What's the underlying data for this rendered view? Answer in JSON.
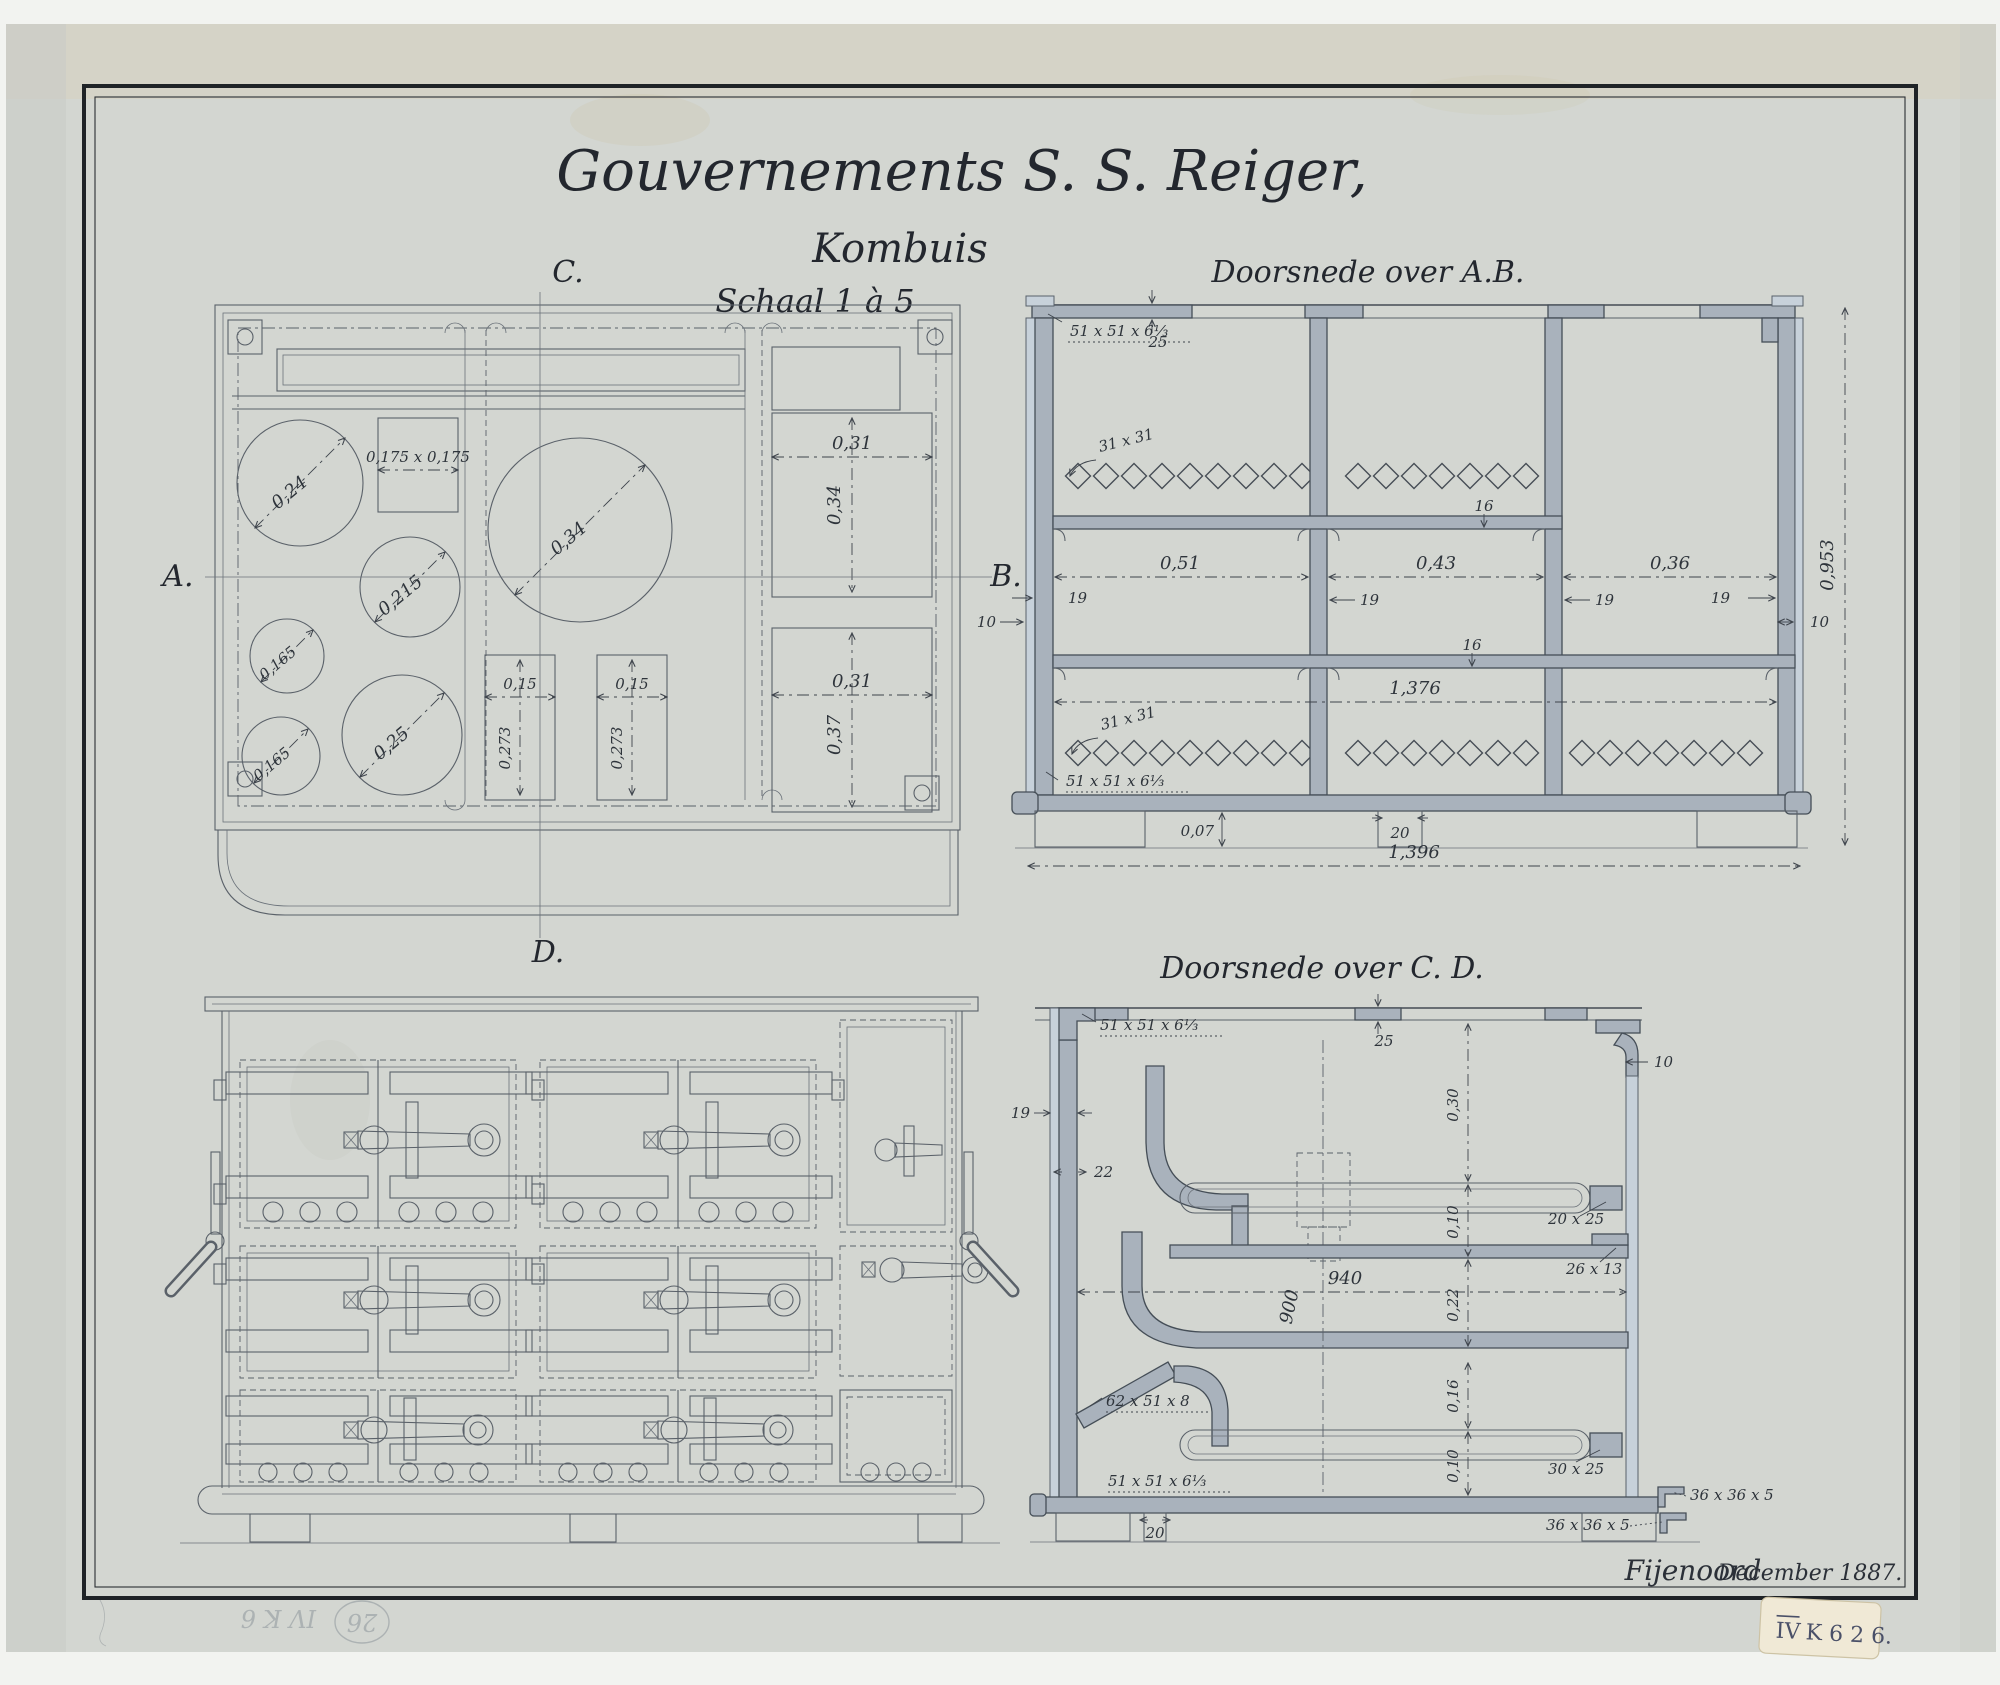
{
  "title": {
    "line1": "Gouvernements S. S. Reiger,",
    "line2": "Kombuis",
    "line3": "Schaal 1 à 5"
  },
  "markers": {
    "a": "A.",
    "b": "B.",
    "c": "C.",
    "d": "D."
  },
  "plan": {
    "circle_1": "0,24",
    "square": "0,175 x 0,175",
    "circle_big": "0,34",
    "circle_2": "0,215",
    "circle_3": "0,165",
    "circle_4": "0,165",
    "circle_5": "0,25",
    "slot1_w": "0,15",
    "slot1_h": "0,273",
    "slot2_w": "0,15",
    "slot2_h": "0,273",
    "rect_top_w": "0,31",
    "rect_top_h": "0,34",
    "rect_bot_w": "0,31",
    "rect_bot_h": "0,37"
  },
  "section_ab": {
    "title": "Doorsnede over A.B.",
    "angle_top": "51 x 51 x 6⅓",
    "plate_top": "25",
    "grate_top": "31 x 31",
    "grate_bottom": "31 x 31",
    "shelf_top": "16",
    "shelf_bottom": "16",
    "bay_1": "0,51",
    "bay_2": "0,43",
    "bay_3": "0,36",
    "wall_1": "19",
    "wall_2": "19",
    "wall_3": "19",
    "wall_4": "19",
    "plate_left": "10",
    "plate_right": "10",
    "height": "0,953",
    "angle_bottom": "51 x 51 x 6⅓",
    "inner_width": "1,376",
    "foot_height": "0,07",
    "foot_width": "20",
    "overall_width": "1,396"
  },
  "section_cd": {
    "title": "Doorsnede over C. D.",
    "angle_top": "51 x 51 x 6⅓",
    "plate_top": "25",
    "plate_right": "10",
    "wall": "19",
    "wall_lower": "22",
    "h_top": "0,30",
    "tray_top": "0,10",
    "bar_top": "20 x 25",
    "ledge": "26 x 13",
    "h_mid": "0,22",
    "width_inner": "940",
    "depth": "900",
    "h_low": "0,16",
    "angle_mid": "62 x 51 x 8",
    "tray_bottom": "0,10",
    "bar_bottom": "30 x 25",
    "angle_bottom": "51 x 51 x 6⅓",
    "foot_width": "20",
    "base_angle_1": "36 x 36 x 5",
    "base_angle_2": "36 x 36 x 5"
  },
  "footer": {
    "signature": "Fijenoord",
    "date": "December 1887."
  },
  "sticker": {
    "roman": "IV",
    "code": "K 6 2 6."
  },
  "pencil": {
    "circled": "26",
    "code": "IV K 6"
  }
}
